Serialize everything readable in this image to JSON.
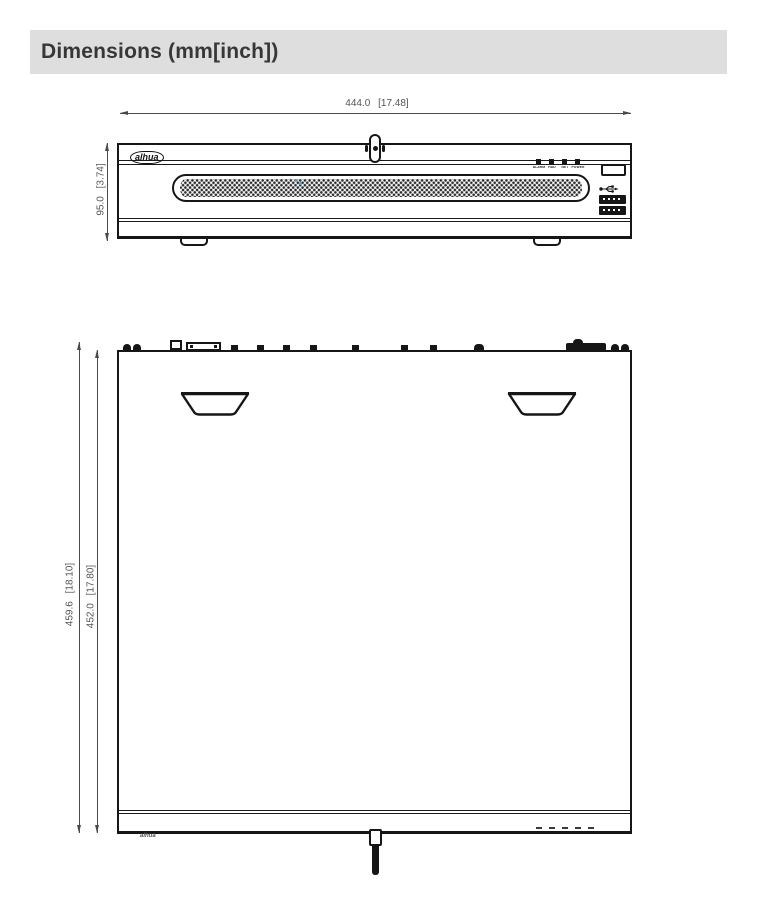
{
  "header": {
    "title": "Dimensions (mm[inch])"
  },
  "front_view": {
    "width_label": "444.0 [17.48]",
    "height_label": "95.0 [3.74]",
    "brand": "alhua",
    "leds": [
      {
        "label": "ALARM"
      },
      {
        "label": "HDD"
      },
      {
        "label": "NET"
      },
      {
        "label": "POWER"
      }
    ]
  },
  "top_view": {
    "outer_depth_label": "459.6 [18.10]",
    "inner_depth_label": "452.0 [17.80]",
    "brand": "alhua"
  },
  "icons": {
    "usb": "usb-icon",
    "lock": "lock-icon",
    "key": "key-icon"
  },
  "colors": {
    "header_bg": "#dedede",
    "line": "#161616",
    "dim_line": "#4a4a4a",
    "dim_text": "#555555",
    "accent_dot": "#58a8cf"
  }
}
